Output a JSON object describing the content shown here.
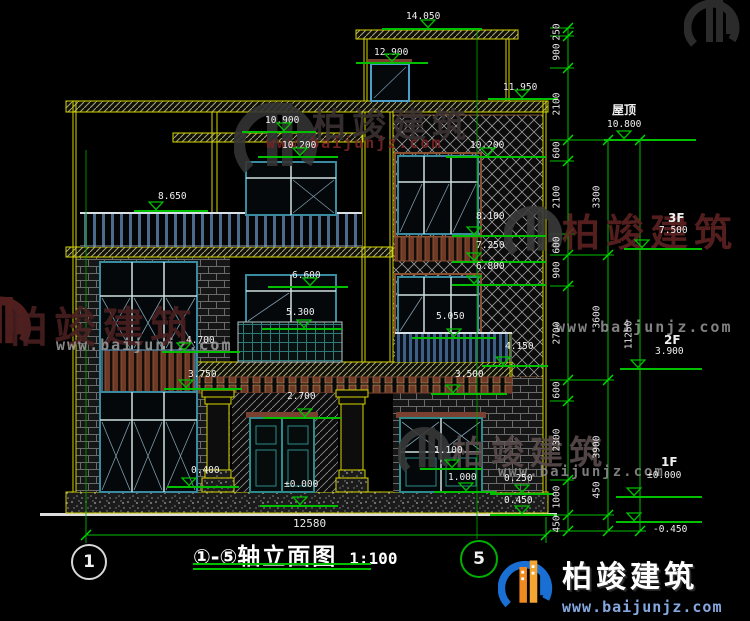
{
  "drawing": {
    "title": {
      "axis_range": "①-⑤",
      "name": "轴立面图",
      "scale": "1:100"
    },
    "axis_bubbles": [
      {
        "label": "1",
        "cx": 87,
        "cy": 560,
        "r": 16,
        "ring": "#d8d8d8",
        "line": {
          "x": 86,
          "y0": 150,
          "y1": 543
        }
      },
      {
        "label": "5",
        "cx": 477,
        "cy": 557,
        "r": 17,
        "ring": "#00b000",
        "line": {
          "x": 477,
          "y0": 30,
          "y1": 539
        }
      }
    ],
    "elevation_markers": [
      {
        "label": "14.050",
        "x": 406,
        "y": 12,
        "lx": 382,
        "lw": 100,
        "ly": 28,
        "tx": 420
      },
      {
        "label": "12.900",
        "x": 374,
        "y": 48,
        "lx": 356,
        "lw": 72,
        "ly": 62,
        "tx": 384
      },
      {
        "label": "11.950",
        "x": 503,
        "y": 83,
        "lx": 488,
        "lw": 70,
        "ly": 98,
        "tx": 514
      },
      {
        "label": "10.900",
        "x": 265,
        "y": 116,
        "lx": 242,
        "lw": 74,
        "ly": 131,
        "tx": 276
      },
      {
        "label": "10.200",
        "x": 282,
        "y": 141,
        "lx": 258,
        "lw": 80,
        "ly": 156,
        "tx": 292
      },
      {
        "label": "10.200",
        "x": 470,
        "y": 141,
        "lx": 446,
        "lw": 100,
        "ly": 156,
        "tx": 480
      },
      {
        "label": "8.650",
        "x": 158,
        "y": 192,
        "lx": 134,
        "lw": 74,
        "ly": 210,
        "tx": 148
      },
      {
        "label": "8.100",
        "x": 476,
        "y": 212,
        "lx": 452,
        "lw": 94,
        "ly": 235,
        "tx": 466
      },
      {
        "label": "7.250",
        "x": 476,
        "y": 241,
        "lx": 452,
        "lw": 94,
        "ly": 261,
        "tx": 466
      },
      {
        "label": "6.800",
        "x": 476,
        "y": 262,
        "lx": 452,
        "lw": 94,
        "ly": 284,
        "tx": 466
      },
      {
        "label": "6.600",
        "x": 292,
        "y": 271,
        "lx": 268,
        "lw": 80,
        "ly": 286,
        "tx": 302
      },
      {
        "label": "5.300",
        "x": 286,
        "y": 308,
        "lx": 262,
        "lw": 80,
        "ly": 328,
        "tx": 296
      },
      {
        "label": "5.050",
        "x": 436,
        "y": 312,
        "lx": 412,
        "lw": 84,
        "ly": 337,
        "tx": 446
      },
      {
        "label": "4.700",
        "x": 186,
        "y": 336,
        "lx": 162,
        "lw": 78,
        "ly": 351,
        "tx": 176
      },
      {
        "label": "3.750",
        "x": 188,
        "y": 370,
        "lx": 164,
        "lw": 78,
        "ly": 388,
        "tx": 178
      },
      {
        "label": "4.150",
        "x": 505,
        "y": 342,
        "lx": 482,
        "lw": 66,
        "ly": 365,
        "tx": 495
      },
      {
        "label": "3.500",
        "x": 455,
        "y": 370,
        "lx": 431,
        "lw": 76,
        "ly": 393,
        "tx": 445
      },
      {
        "label": "2.700",
        "x": 287,
        "y": 392,
        "lx": 263,
        "lw": 78,
        "ly": 417,
        "tx": 297
      },
      {
        "label": "0.400",
        "x": 191,
        "y": 466,
        "lx": 167,
        "lw": 72,
        "ly": 486,
        "tx": 181
      },
      {
        "label": "±0.000",
        "x": 284,
        "y": 480,
        "lx": 260,
        "lw": 78,
        "ly": 505,
        "tx": 292
      },
      {
        "label": "1.100",
        "x": 434,
        "y": 446,
        "lx": 420,
        "lw": 62,
        "ly": 468,
        "tx": 444
      },
      {
        "label": "1.000",
        "x": 448,
        "y": 473,
        "lx": 434,
        "lw": 62,
        "ly": 491,
        "tx": 458
      },
      {
        "label": "0.250",
        "x": 504,
        "y": 474,
        "lx": 490,
        "lw": 64,
        "ly": 493,
        "tx": 514
      },
      {
        "label": "0.450",
        "x": 504,
        "y": 496,
        "lx": 490,
        "lw": 64,
        "ly": 514,
        "tx": 514
      },
      {
        "name": "屋顶",
        "nx": 612,
        "ny": 104,
        "label": "10.800",
        "x": 607,
        "y": 120,
        "lx": 604,
        "lw": 92,
        "ly": 139,
        "tx": 616
      },
      {
        "name": "3F",
        "nx": 668,
        "ny": 212,
        "label": "7.500",
        "x": 659,
        "y": 226,
        "lx": 624,
        "lw": 78,
        "ly": 248,
        "tx": 634
      },
      {
        "name": "2F",
        "nx": 664,
        "ny": 334,
        "label": "3.900",
        "x": 655,
        "y": 347,
        "lx": 620,
        "lw": 82,
        "ly": 368,
        "tx": 630
      },
      {
        "name": "1F",
        "nx": 661,
        "ny": 456,
        "label": "±0.000",
        "x": 647,
        "y": 471,
        "lx": 616,
        "lw": 86,
        "ly": 496,
        "tx": 626
      },
      {
        "label": "-0.450",
        "x": 653,
        "y": 525,
        "lx": 616,
        "lw": 86,
        "ly": 521,
        "tb": true,
        "tx": 626
      }
    ],
    "dim_columns": [
      {
        "x": 568,
        "tx": 557,
        "ticks": [
          28,
          36,
          68,
          140,
          161,
          234,
          255,
          286,
          380,
          401,
          480,
          515,
          531
        ],
        "segs": [
          {
            "v": "250",
            "m": 32
          },
          {
            "v": "900",
            "m": 52
          },
          {
            "v": "2100",
            "m": 104
          },
          {
            "v": "600",
            "m": 150
          },
          {
            "v": "2100",
            "m": 197
          },
          {
            "v": "600",
            "m": 245
          },
          {
            "v": "900",
            "m": 270
          },
          {
            "v": "2700",
            "m": 333
          },
          {
            "v": "600",
            "m": 390
          },
          {
            "v": "2300",
            "m": 440
          },
          {
            "v": "1000",
            "m": 497
          },
          {
            "v": "450",
            "m": 524
          }
        ]
      },
      {
        "x": 608,
        "tx": 597,
        "ticks": [
          140,
          255,
          380,
          515,
          531
        ],
        "segs": [
          {
            "v": "3300",
            "m": 197
          },
          {
            "v": "3600",
            "m": 317
          },
          {
            "v": "3900",
            "m": 447
          },
          {
            "v": "450",
            "m": 490
          }
        ]
      },
      {
        "x": 640,
        "tx": 629,
        "ticks": [
          140,
          531
        ],
        "segs": [
          {
            "v": "11250",
            "m": 335
          }
        ]
      }
    ],
    "overall_width": {
      "value": "12580",
      "x0": 86,
      "x1": 546,
      "y": 535,
      "tx": 293,
      "ty": 518
    }
  },
  "watermark": {
    "text": "柏竣建筑",
    "url": "www.baijunjz.com",
    "instances": [
      {
        "gx": 234,
        "gy": 88,
        "gs": 1.5,
        "gc": "#343434",
        "cx": 312,
        "cy": 98,
        "cs": 34,
        "cc": "#3b3232",
        "ux": 266,
        "uy": 134,
        "us": 15,
        "uc": "#7a2424",
        "show_c": true,
        "show_u": true
      },
      {
        "gx": 504,
        "gy": 196,
        "gs": 1.05,
        "gc": "#3a3a3a",
        "cx": 562,
        "cy": 202,
        "cs": 38,
        "cc": "#5e2222",
        "ux": 556,
        "uy": 318,
        "us": 15,
        "uc": "#8f8f8f",
        "show_c": true,
        "show_u": true
      },
      {
        "gx": -30,
        "gy": 286,
        "gs": 1.1,
        "gc": "#5a2222",
        "cx": 6,
        "cy": 294,
        "cs": 42,
        "cc": "#4a2020",
        "ux": 56,
        "uy": 336,
        "us": 15,
        "uc": "#989898",
        "show_c": true,
        "show_u": true
      },
      {
        "gx": 398,
        "gy": 418,
        "gs": 0.95,
        "gc": "#383838",
        "cx": 452,
        "cy": 426,
        "cs": 33,
        "cc": "#5a4c4c",
        "ux": 498,
        "uy": 464,
        "us": 14,
        "uc": "#8a8a8a",
        "show_c": true,
        "show_u": true
      },
      {
        "gx": 684,
        "gy": -10,
        "gs": 1.0,
        "gc": "#303030",
        "show_c": false,
        "show_u": false
      }
    ]
  },
  "brand": {
    "name": "柏竣建筑",
    "url": "www.baijunjz.com"
  }
}
